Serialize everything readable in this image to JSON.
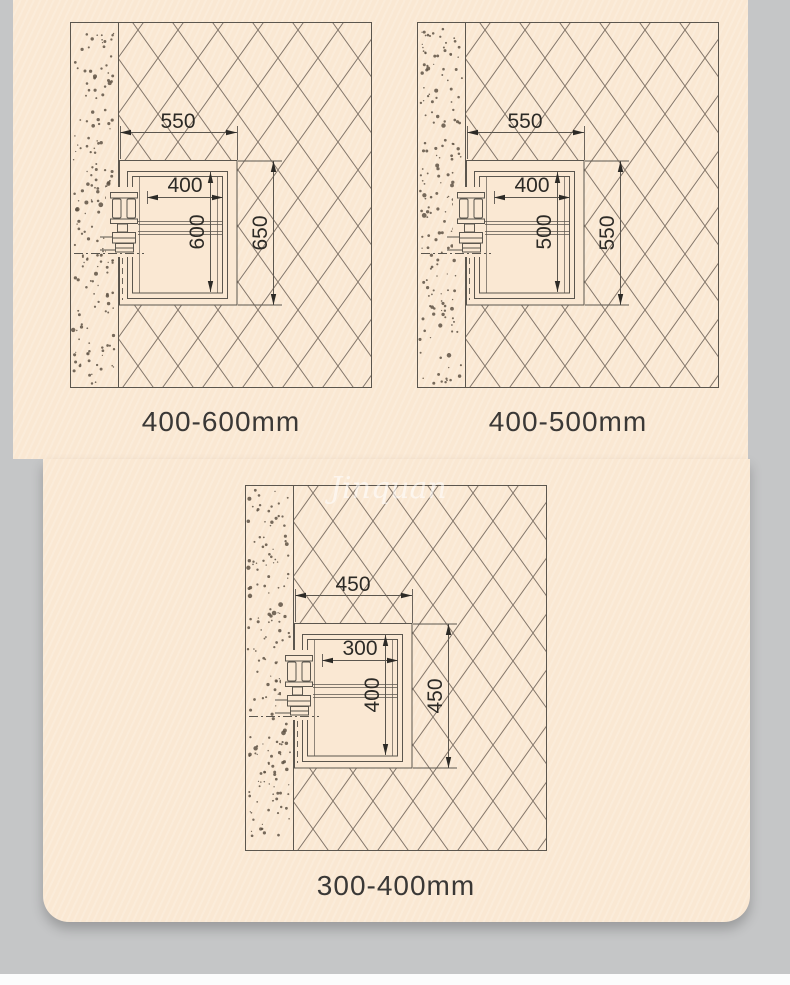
{
  "page": {
    "background_color": "#c5c6c7",
    "card_color": "#fae8d3",
    "bottom_strip_color": "#fcfcfc",
    "watermark_text": "Jinquan"
  },
  "drawing_colors": {
    "line": "#5b564e",
    "hatch": "#83766a",
    "dimension_text": "#2c2a26",
    "stipple": "#5e5244",
    "label_text": "#3a3836"
  },
  "diagrams": [
    {
      "name": "top-left",
      "caption": "400-600mm",
      "dims": {
        "opening_width": "550",
        "car_width": "400",
        "car_height": "600",
        "opening_height": "650"
      }
    },
    {
      "name": "top-right",
      "caption": "400-500mm",
      "dims": {
        "opening_width": "550",
        "car_width": "400",
        "car_height": "500",
        "opening_height": "550"
      }
    },
    {
      "name": "bottom-center",
      "caption": "300-400mm",
      "dims": {
        "opening_width": "450",
        "car_width": "300",
        "car_height": "400",
        "opening_height": "450"
      }
    }
  ]
}
